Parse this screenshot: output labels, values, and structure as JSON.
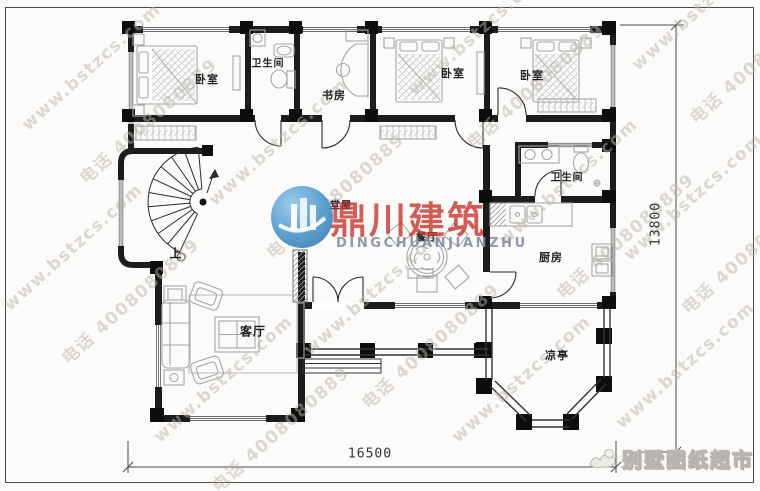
{
  "watermark": {
    "line1": "www.bstzcs.com",
    "line2": "电话 4008080889"
  },
  "logo": {
    "brand_cn": "鼎川建筑",
    "brand_en": "DINGCHUANJIANZHU"
  },
  "footer_brand": {
    "text": "别墅图纸超市"
  },
  "rooms": {
    "bedroom1": "卧室",
    "bath1": "卫生间",
    "study": "书房",
    "bedroom2": "卧室",
    "bedroom3": "卧室",
    "hall": "堂屋",
    "dining": "餐厅",
    "bath2": "卫生间",
    "kitchen": "厨房",
    "living": "客厅",
    "gazebo": "凉亭",
    "stair_up": "上"
  },
  "dimensions": {
    "width": "16500",
    "height": "13800"
  },
  "colors": {
    "wall": "#1c1c1c",
    "furniture": "#a6a6a6",
    "logo_blue": "#3f8ec6",
    "logo_red": "#c72f28"
  }
}
